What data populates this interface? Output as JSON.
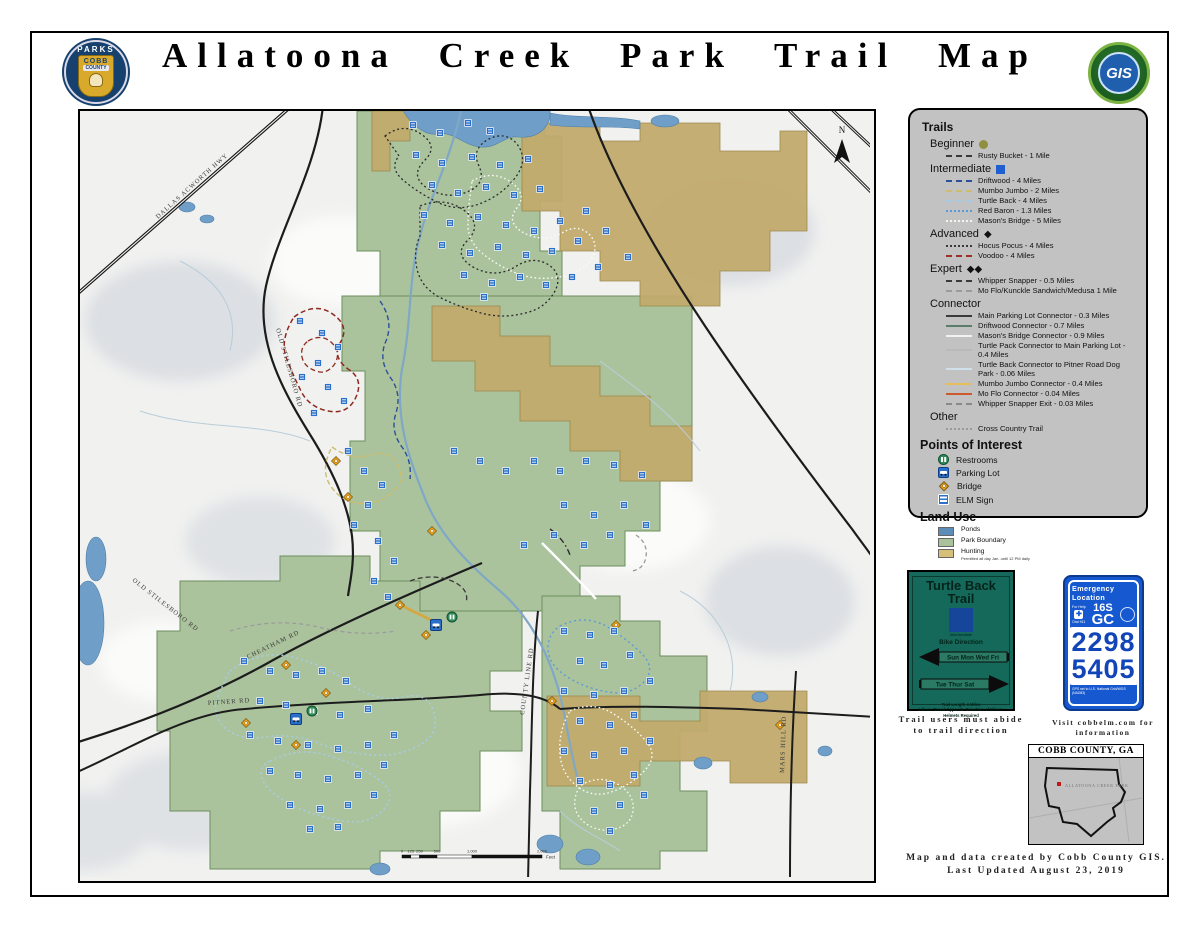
{
  "header": {
    "title": "Allatoona Creek Park Trail Map",
    "parks_logo": {
      "top": "PARKS",
      "mid": "COBB",
      "bottom": "COUNTY"
    },
    "gis_logo": {
      "text": "GIS"
    }
  },
  "legend": {
    "title": "Trails",
    "groups": [
      {
        "label": "Beginner",
        "symbol": "circle",
        "items": [
          {
            "name": "Rusty Bucket - 1 Mile",
            "color": "#3a3a3a",
            "dash": "dashed"
          }
        ]
      },
      {
        "label": "Intermediate",
        "symbol": "square",
        "items": [
          {
            "name": "Driftwood - 4 Miles",
            "color": "#2d4f97",
            "dash": "dashed"
          },
          {
            "name": "Mumbo Jumbo - 2 Miles",
            "color": "#cdbd6e",
            "dash": "dashed"
          },
          {
            "name": "Turtle Back - 4 Miles",
            "color": "#a9cbe2",
            "dash": "dashed"
          },
          {
            "name": "Red Baron - 1.3 Miles",
            "color": "#5b9bd5",
            "dash": "dotted"
          },
          {
            "name": "Mason's Bridge - 5 Miles",
            "color": "#f5f5f0",
            "dash": "dotted"
          }
        ]
      },
      {
        "label": "Advanced",
        "symbol": "diamond",
        "items": [
          {
            "name": "Hocus Pocus - 4 Miles",
            "color": "#3a3a3a",
            "dash": "dotted"
          },
          {
            "name": "Voodoo - 4 Miles",
            "color": "#9e2f26",
            "dash": "dashed"
          }
        ]
      },
      {
        "label": "Expert",
        "symbol": "double-diamond",
        "items": [
          {
            "name": "Whipper Snapper - 0.5 Miles",
            "color": "#3a3a3a",
            "dash": "dashed"
          },
          {
            "name": "Mo Flo/Kunckle Sandwich/Medusa 1 Mile",
            "color": "#9a9a9a",
            "dash": "dashed"
          }
        ]
      },
      {
        "label": "Connector",
        "symbol": "none",
        "items": [
          {
            "name": "Main Parking Lot Connector - 0.3 Miles",
            "color": "#3a3a3a",
            "dash": "solid"
          },
          {
            "name": "Driftwood Connector - 0.7 Miles",
            "color": "#5a7d6d",
            "dash": "solid"
          },
          {
            "name": "Mason's Bridge Connector - 0.9 Miles",
            "color": "#f2f2ee",
            "dash": "solid"
          },
          {
            "name": "Turtle Pack Connector to Main Parking Lot - 0.4 Miles",
            "color": "#b9b9b9",
            "dash": "solid"
          },
          {
            "name": "Turtle Back Connector to Pitner Road Dog Park - 0.06 Miles",
            "color": "#cfe0ea",
            "dash": "solid"
          },
          {
            "name": "Mumbo Jumbo Connector - 0.4 Miles",
            "color": "#e5bd5a",
            "dash": "solid"
          },
          {
            "name": "Mo Flo Connector - 0.04 Miles",
            "color": "#cc5a2e",
            "dash": "solid"
          },
          {
            "name": "Whipper Snapper Exit - 0.03 Miles",
            "color": "#8a8a8a",
            "dash": "dashed"
          }
        ]
      },
      {
        "label": "Other",
        "symbol": "none",
        "items": [
          {
            "name": "Cross Country Trail",
            "color": "#9a9a9a",
            "dash": "dotted"
          }
        ]
      }
    ],
    "poi": {
      "title": "Points of Interest",
      "items": [
        "Restrooms",
        "Parking Lot",
        "Bridge",
        "ELM Sign"
      ]
    },
    "landuse": {
      "title": "Land Use",
      "items": [
        {
          "name": "Ponds",
          "color": "#5b8db8"
        },
        {
          "name": "Park Boundary",
          "color": "#a9c29b"
        },
        {
          "name": "Hunting",
          "color": "#d6c079",
          "note": "Permitted all day Jan. until 12 PM daily"
        }
      ]
    }
  },
  "map": {
    "north_label": "N",
    "road_labels": [
      {
        "text": "DALLAS ACWORTH HWY",
        "x": 78,
        "y": 108,
        "rot": -42
      },
      {
        "text": "OLD STILESBORO RD",
        "x": 196,
        "y": 218,
        "rot": 74
      },
      {
        "text": "OLD STILESBORO RD",
        "x": 52,
        "y": 470,
        "rot": 38
      },
      {
        "text": "CHEATHAM RD",
        "x": 168,
        "y": 548,
        "rot": -26
      },
      {
        "text": "PITNER RD",
        "x": 128,
        "y": 594,
        "rot": -4
      },
      {
        "text": "COUNTY LINE RD",
        "x": 444,
        "y": 604,
        "rot": -82
      },
      {
        "text": "MARS HILL RD",
        "x": 704,
        "y": 662,
        "rot": -88
      }
    ],
    "scale": {
      "stops": [
        {
          "label": "0",
          "f": 0
        },
        {
          "label": "125",
          "f": 0.0625
        },
        {
          "label": "250",
          "f": 0.125
        },
        {
          "label": "500",
          "f": 0.25
        },
        {
          "label": "1,000",
          "f": 0.5
        },
        {
          "label": "2,000",
          "f": 1
        }
      ],
      "unit": "Feet"
    },
    "markers": [
      [
        333,
        14
      ],
      [
        360,
        22
      ],
      [
        388,
        12
      ],
      [
        410,
        20
      ],
      [
        336,
        44
      ],
      [
        362,
        52
      ],
      [
        392,
        46
      ],
      [
        420,
        54
      ],
      [
        448,
        48
      ],
      [
        352,
        74
      ],
      [
        378,
        82
      ],
      [
        406,
        76
      ],
      [
        434,
        84
      ],
      [
        460,
        78
      ],
      [
        344,
        104
      ],
      [
        370,
        112
      ],
      [
        398,
        106
      ],
      [
        426,
        114
      ],
      [
        454,
        120
      ],
      [
        480,
        110
      ],
      [
        506,
        100
      ],
      [
        362,
        134
      ],
      [
        390,
        142
      ],
      [
        418,
        136
      ],
      [
        446,
        144
      ],
      [
        472,
        140
      ],
      [
        498,
        130
      ],
      [
        526,
        120
      ],
      [
        384,
        164
      ],
      [
        412,
        172
      ],
      [
        440,
        166
      ],
      [
        466,
        174
      ],
      [
        492,
        166
      ],
      [
        518,
        156
      ],
      [
        548,
        146
      ],
      [
        404,
        186
      ],
      [
        220,
        210
      ],
      [
        242,
        222
      ],
      [
        258,
        236
      ],
      [
        238,
        252
      ],
      [
        222,
        266
      ],
      [
        248,
        276
      ],
      [
        264,
        290
      ],
      [
        234,
        302
      ],
      [
        268,
        340
      ],
      [
        284,
        360
      ],
      [
        302,
        374
      ],
      [
        288,
        394
      ],
      [
        274,
        414
      ],
      [
        298,
        430
      ],
      [
        314,
        450
      ],
      [
        294,
        470
      ],
      [
        308,
        486
      ],
      [
        374,
        340
      ],
      [
        400,
        350
      ],
      [
        426,
        360
      ],
      [
        454,
        350
      ],
      [
        480,
        360
      ],
      [
        506,
        350
      ],
      [
        534,
        354
      ],
      [
        562,
        364
      ],
      [
        484,
        394
      ],
      [
        514,
        404
      ],
      [
        544,
        394
      ],
      [
        566,
        414
      ],
      [
        474,
        424
      ],
      [
        444,
        434
      ],
      [
        504,
        434
      ],
      [
        530,
        424
      ],
      [
        164,
        550
      ],
      [
        190,
        560
      ],
      [
        216,
        564
      ],
      [
        242,
        560
      ],
      [
        266,
        570
      ],
      [
        180,
        590
      ],
      [
        206,
        594
      ],
      [
        234,
        600
      ],
      [
        260,
        604
      ],
      [
        288,
        598
      ],
      [
        170,
        624
      ],
      [
        198,
        630
      ],
      [
        228,
        634
      ],
      [
        258,
        638
      ],
      [
        288,
        634
      ],
      [
        314,
        624
      ],
      [
        190,
        660
      ],
      [
        218,
        664
      ],
      [
        248,
        668
      ],
      [
        278,
        664
      ],
      [
        304,
        654
      ],
      [
        210,
        694
      ],
      [
        240,
        698
      ],
      [
        268,
        694
      ],
      [
        294,
        684
      ],
      [
        230,
        718
      ],
      [
        258,
        716
      ],
      [
        484,
        520
      ],
      [
        510,
        524
      ],
      [
        534,
        520
      ],
      [
        500,
        550
      ],
      [
        524,
        554
      ],
      [
        550,
        544
      ],
      [
        484,
        580
      ],
      [
        514,
        584
      ],
      [
        544,
        580
      ],
      [
        570,
        570
      ],
      [
        500,
        610
      ],
      [
        530,
        614
      ],
      [
        554,
        604
      ],
      [
        484,
        640
      ],
      [
        514,
        644
      ],
      [
        544,
        640
      ],
      [
        570,
        630
      ],
      [
        500,
        670
      ],
      [
        530,
        674
      ],
      [
        554,
        664
      ],
      [
        514,
        700
      ],
      [
        540,
        694
      ],
      [
        564,
        684
      ],
      [
        530,
        720
      ]
    ],
    "bridges": [
      [
        256,
        350
      ],
      [
        268,
        386
      ],
      [
        320,
        494
      ],
      [
        346,
        524
      ],
      [
        206,
        554
      ],
      [
        246,
        582
      ],
      [
        166,
        612
      ],
      [
        216,
        634
      ],
      [
        536,
        514
      ],
      [
        472,
        590
      ],
      [
        700,
        614
      ],
      [
        352,
        420
      ]
    ],
    "parking": [
      [
        356,
        514
      ],
      [
        216,
        608
      ]
    ],
    "restrooms": [
      [
        372,
        506
      ],
      [
        232,
        600
      ]
    ]
  },
  "turtle_sign": {
    "title_line1": "Turtle Back",
    "title_line2": "Trail",
    "difficulty": "Intermediate",
    "bike_direction": "Bike Direction",
    "left_days": "Sun Mon Wed Fri",
    "right_days": "Tue Thur Sat",
    "footer1": "Trail Length 4 Miles",
    "footer2": "Hikers Travel Opposite Direction of Bikers",
    "footer3": "Helmets Required",
    "caption1": "Trail users must abide",
    "caption2": "to trail direction"
  },
  "emergency_sign": {
    "header": "Emergency Location",
    "for_help": "For Help",
    "dial": "Dial 911",
    "grid1": "16S",
    "grid2": "GC",
    "num1": "2298",
    "num2": "5405",
    "footer": "GPS set to U.S. National Grid/WGS (NAD83)",
    "caption1": "Visit cobbelm.com for",
    "caption2": "information"
  },
  "inset": {
    "title": "COBB COUNTY, GA",
    "marker_label": "ALLATOONA CREEK PARK"
  },
  "credits": {
    "line1": "Map and data created by Cobb County GIS.",
    "line2": "Last Updated August 23, 2019"
  },
  "colors": {
    "park_green": "#abc39d",
    "hunting_tan": "#c2ab6d",
    "water_blue": "#6f9fc8",
    "legend_gray": "#c2c2c2",
    "sign_green": "#15695a",
    "sign_blue": "#1558cf"
  }
}
